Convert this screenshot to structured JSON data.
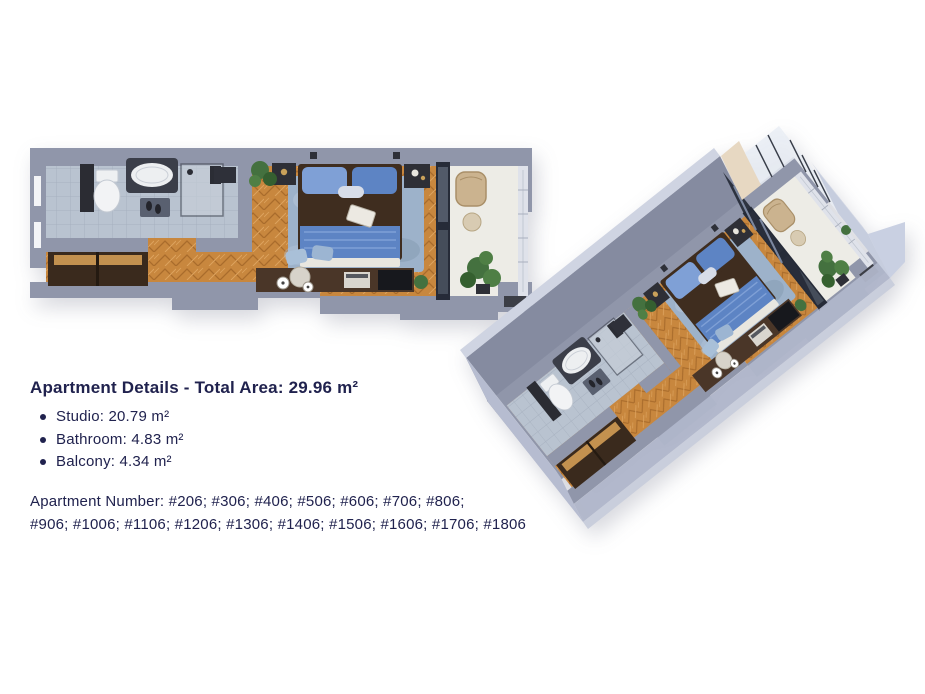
{
  "palette": {
    "navy": "#20224e",
    "wall": "#9096aa",
    "wallDark": "#6e7386",
    "wallLight": "#cfd4e2",
    "wall3dFace": "#858ba0",
    "wall3dOuter": "#b6bcd0",
    "wood": "#c8873e",
    "woodLine": "#a96c2c",
    "tile": "#b9c3d0",
    "rug": "#9db2ca",
    "bedBlue": "#5d84c4",
    "bedBlueLight": "#7fa0d6",
    "bedBrown": "#3f2d1f",
    "closet": "#3a2a1d",
    "balconyFloor": "#edece6",
    "plant": "#44713f",
    "glassDark": "#262b38"
  },
  "details": {
    "title": "Apartment Details - Total Area: 29.96 m²",
    "items": [
      {
        "label": "Studio: 20.79 m²"
      },
      {
        "label": "Bathroom: 4.83 m²"
      },
      {
        "label": "Balcony: 4.34 m²"
      }
    ]
  },
  "apartment_numbers": {
    "line1": "Apartment Number: #206; #306; #406; #506; #606; #706; #806;",
    "line2": "#906; #1006; #1106; #1206; #1306; #1406; #1506; #1606; #1706; #1806"
  }
}
